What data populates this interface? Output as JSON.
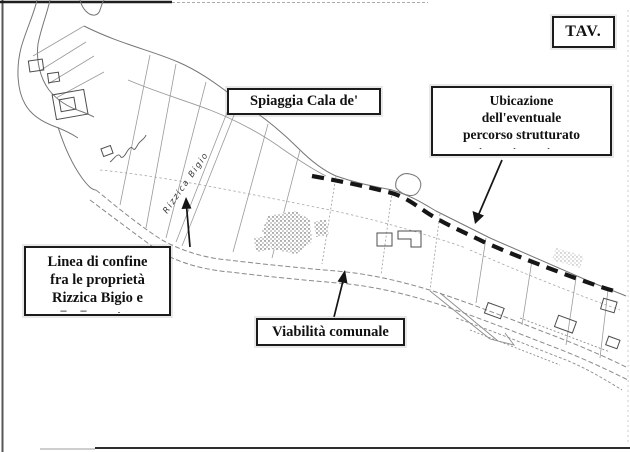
{
  "boxes": {
    "tav": {
      "label": "TAV."
    },
    "spiaggia": {
      "label": "Spiaggia Cala de'"
    },
    "ubicazione": {
      "line1": "Ubicazione",
      "line2": "dell'eventuale",
      "line3": "percorso strutturato",
      "clipped_marks": ". .  ."
    },
    "confine": {
      "line1": "Linea di confine",
      "line2": "fra le proprietà",
      "line3": "Rizzica Bigio e",
      "clipped_marks": "–– ."
    },
    "viabilita": {
      "label": "Viabilità comunale"
    }
  },
  "map": {
    "handwriting_parcel_label": "Rizzica Bigio"
  },
  "colors": {
    "paper": "#ffffff",
    "ink": "#1b1b1b",
    "map_line": "#7d7d7d",
    "dashed_path": "#161616"
  }
}
